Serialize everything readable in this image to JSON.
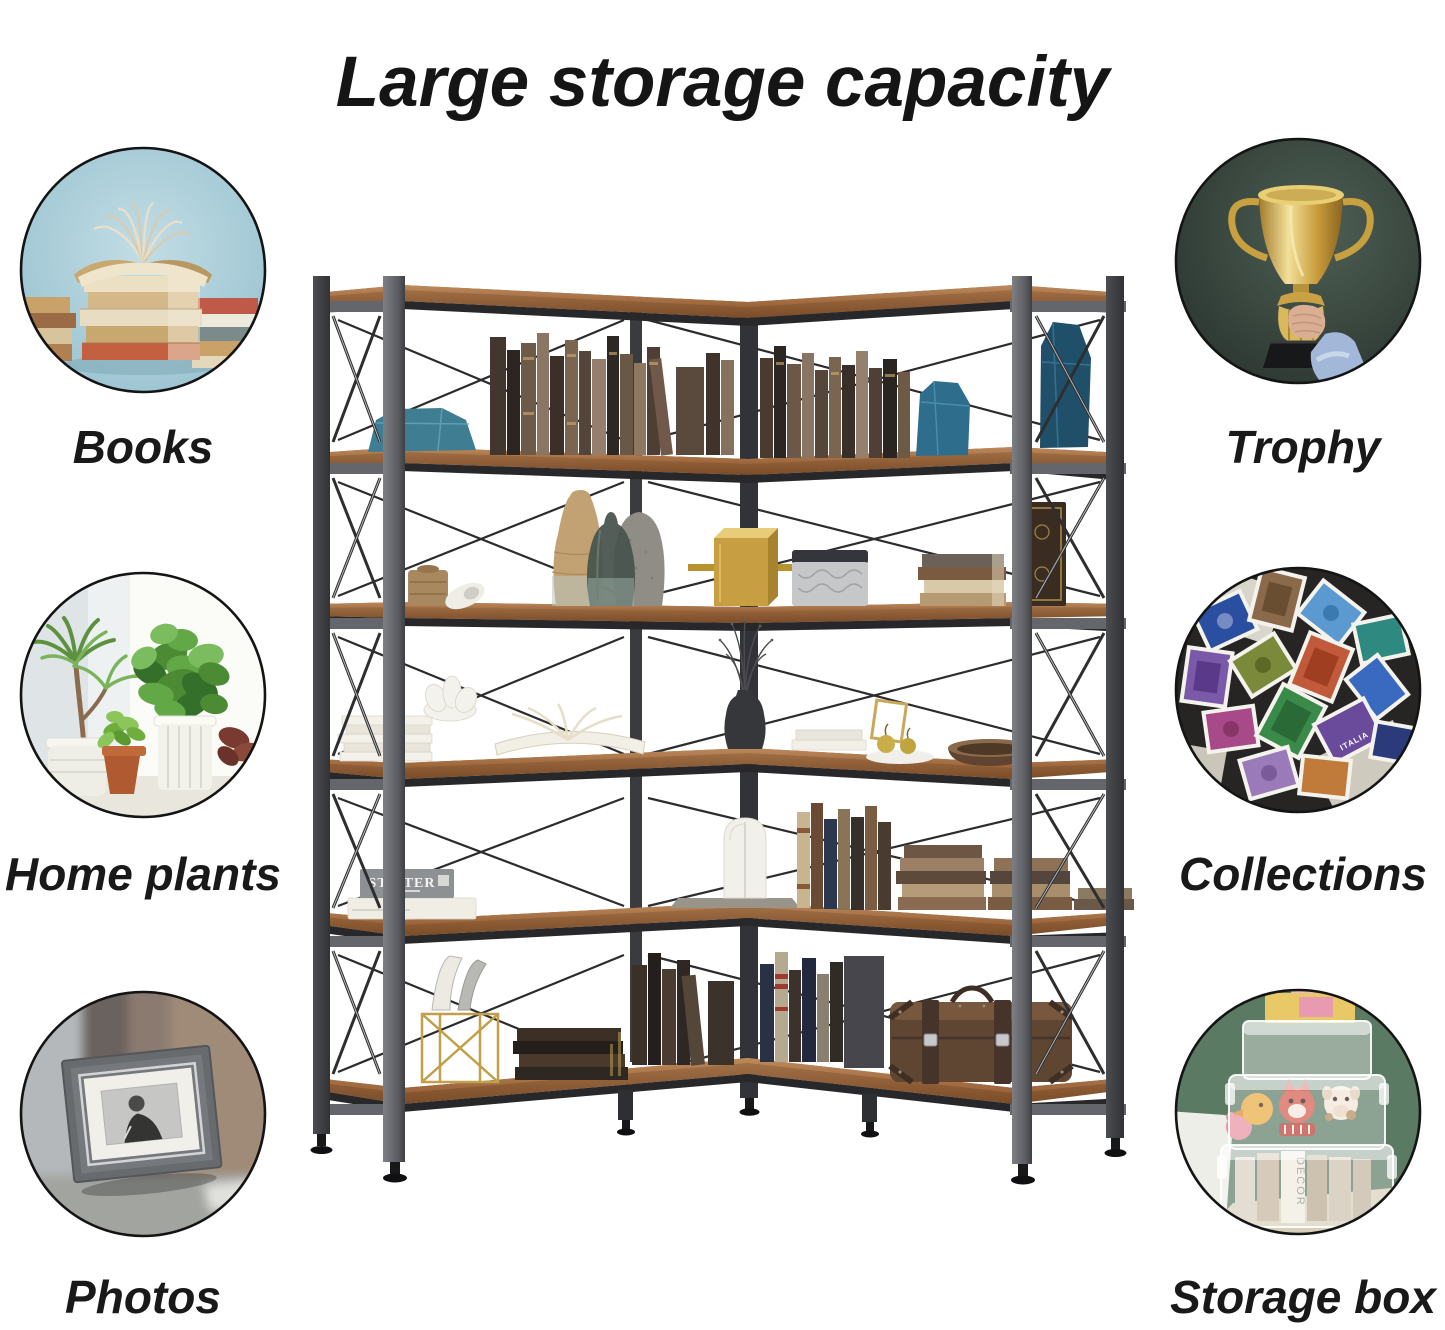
{
  "title": "Large storage capacity",
  "left_column": {
    "items": [
      {
        "label": "Books",
        "icon": "books-photo"
      },
      {
        "label": "Home plants",
        "icon": "home-plants-photo"
      },
      {
        "label": "Photos",
        "icon": "photos-photo"
      }
    ]
  },
  "right_column": {
    "items": [
      {
        "label": "Trophy",
        "icon": "trophy-photo"
      },
      {
        "label": "Collections",
        "icon": "collections-photo"
      },
      {
        "label": "Storage box",
        "icon": "storage-box-photo"
      }
    ]
  },
  "shelf": {
    "tiers": 6,
    "book_spine_title": "STIFTER",
    "magazine_title": "DECOR",
    "stamp_text": "ITALIA",
    "colors": {
      "wood": "#8a5a36",
      "metal_frame": "#3a3b3f",
      "background": "#ffffff",
      "text": "#161616"
    }
  }
}
